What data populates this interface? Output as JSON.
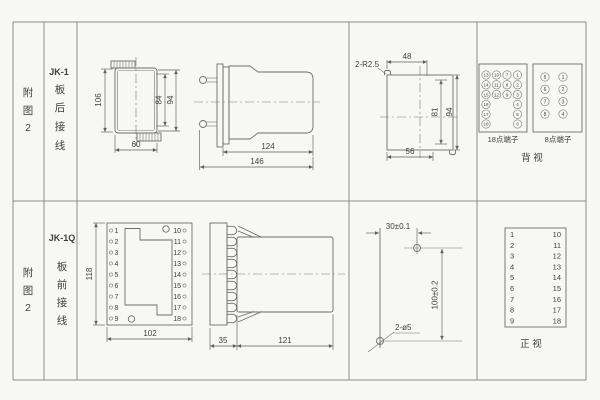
{
  "sheet": {
    "rows": [
      {
        "fig": [
          "附",
          "图",
          "2"
        ],
        "model": "JK-1",
        "wiring": [
          "板",
          "后",
          "接",
          "线"
        ]
      },
      {
        "fig": [
          "附",
          "图",
          "2"
        ],
        "model": "JK-1Q",
        "wiring": [
          "板",
          "前",
          "接",
          "线"
        ]
      }
    ]
  },
  "jk1": {
    "top_view": {
      "dim_height": "106",
      "dim_inner_height": "84",
      "dim_outer_height": "94",
      "dim_width": "60"
    },
    "side_view": {
      "dim_body_length": "124",
      "dim_total_length": "146"
    },
    "cutout": {
      "corner_note": "2-R2.5",
      "dim_top_width": "48",
      "dim_inner_height": "81",
      "dim_height": "94",
      "dim_bottom_width": "56"
    },
    "terminals_18": {
      "label": "18点端子",
      "numbers": [
        "13",
        "10",
        "7",
        "1",
        "14",
        "11",
        "8",
        "2",
        "15",
        "12",
        "9",
        "3",
        "16",
        "4",
        "17",
        "5",
        "18",
        "6"
      ]
    },
    "terminals_8": {
      "label": "8点端子",
      "numbers": [
        "5",
        "1",
        "6",
        "2",
        "7",
        "3",
        "8",
        "4"
      ]
    },
    "view_label": "背  视"
  },
  "jk1q": {
    "front_view": {
      "left_terminals": [
        "1",
        "2",
        "3",
        "4",
        "5",
        "6",
        "7",
        "8",
        "9"
      ],
      "right_terminals": [
        "10",
        "11",
        "12",
        "13",
        "14",
        "15",
        "16",
        "17",
        "18"
      ],
      "dim_height": "118",
      "dim_width": "102"
    },
    "side_view": {
      "dim_panel_depth": "35",
      "dim_body_length": "121"
    },
    "drilling": {
      "dim_horizontal": "30±0.1",
      "dim_vertical": "100±0.2",
      "hole_note": "2-ø5"
    },
    "terminal_table": {
      "left": [
        "1",
        "2",
        "3",
        "4",
        "5",
        "6",
        "7",
        "8",
        "9"
      ],
      "right": [
        "10",
        "11",
        "12",
        "13",
        "14",
        "15",
        "16",
        "17",
        "18"
      ],
      "view_label": "正  视"
    }
  }
}
